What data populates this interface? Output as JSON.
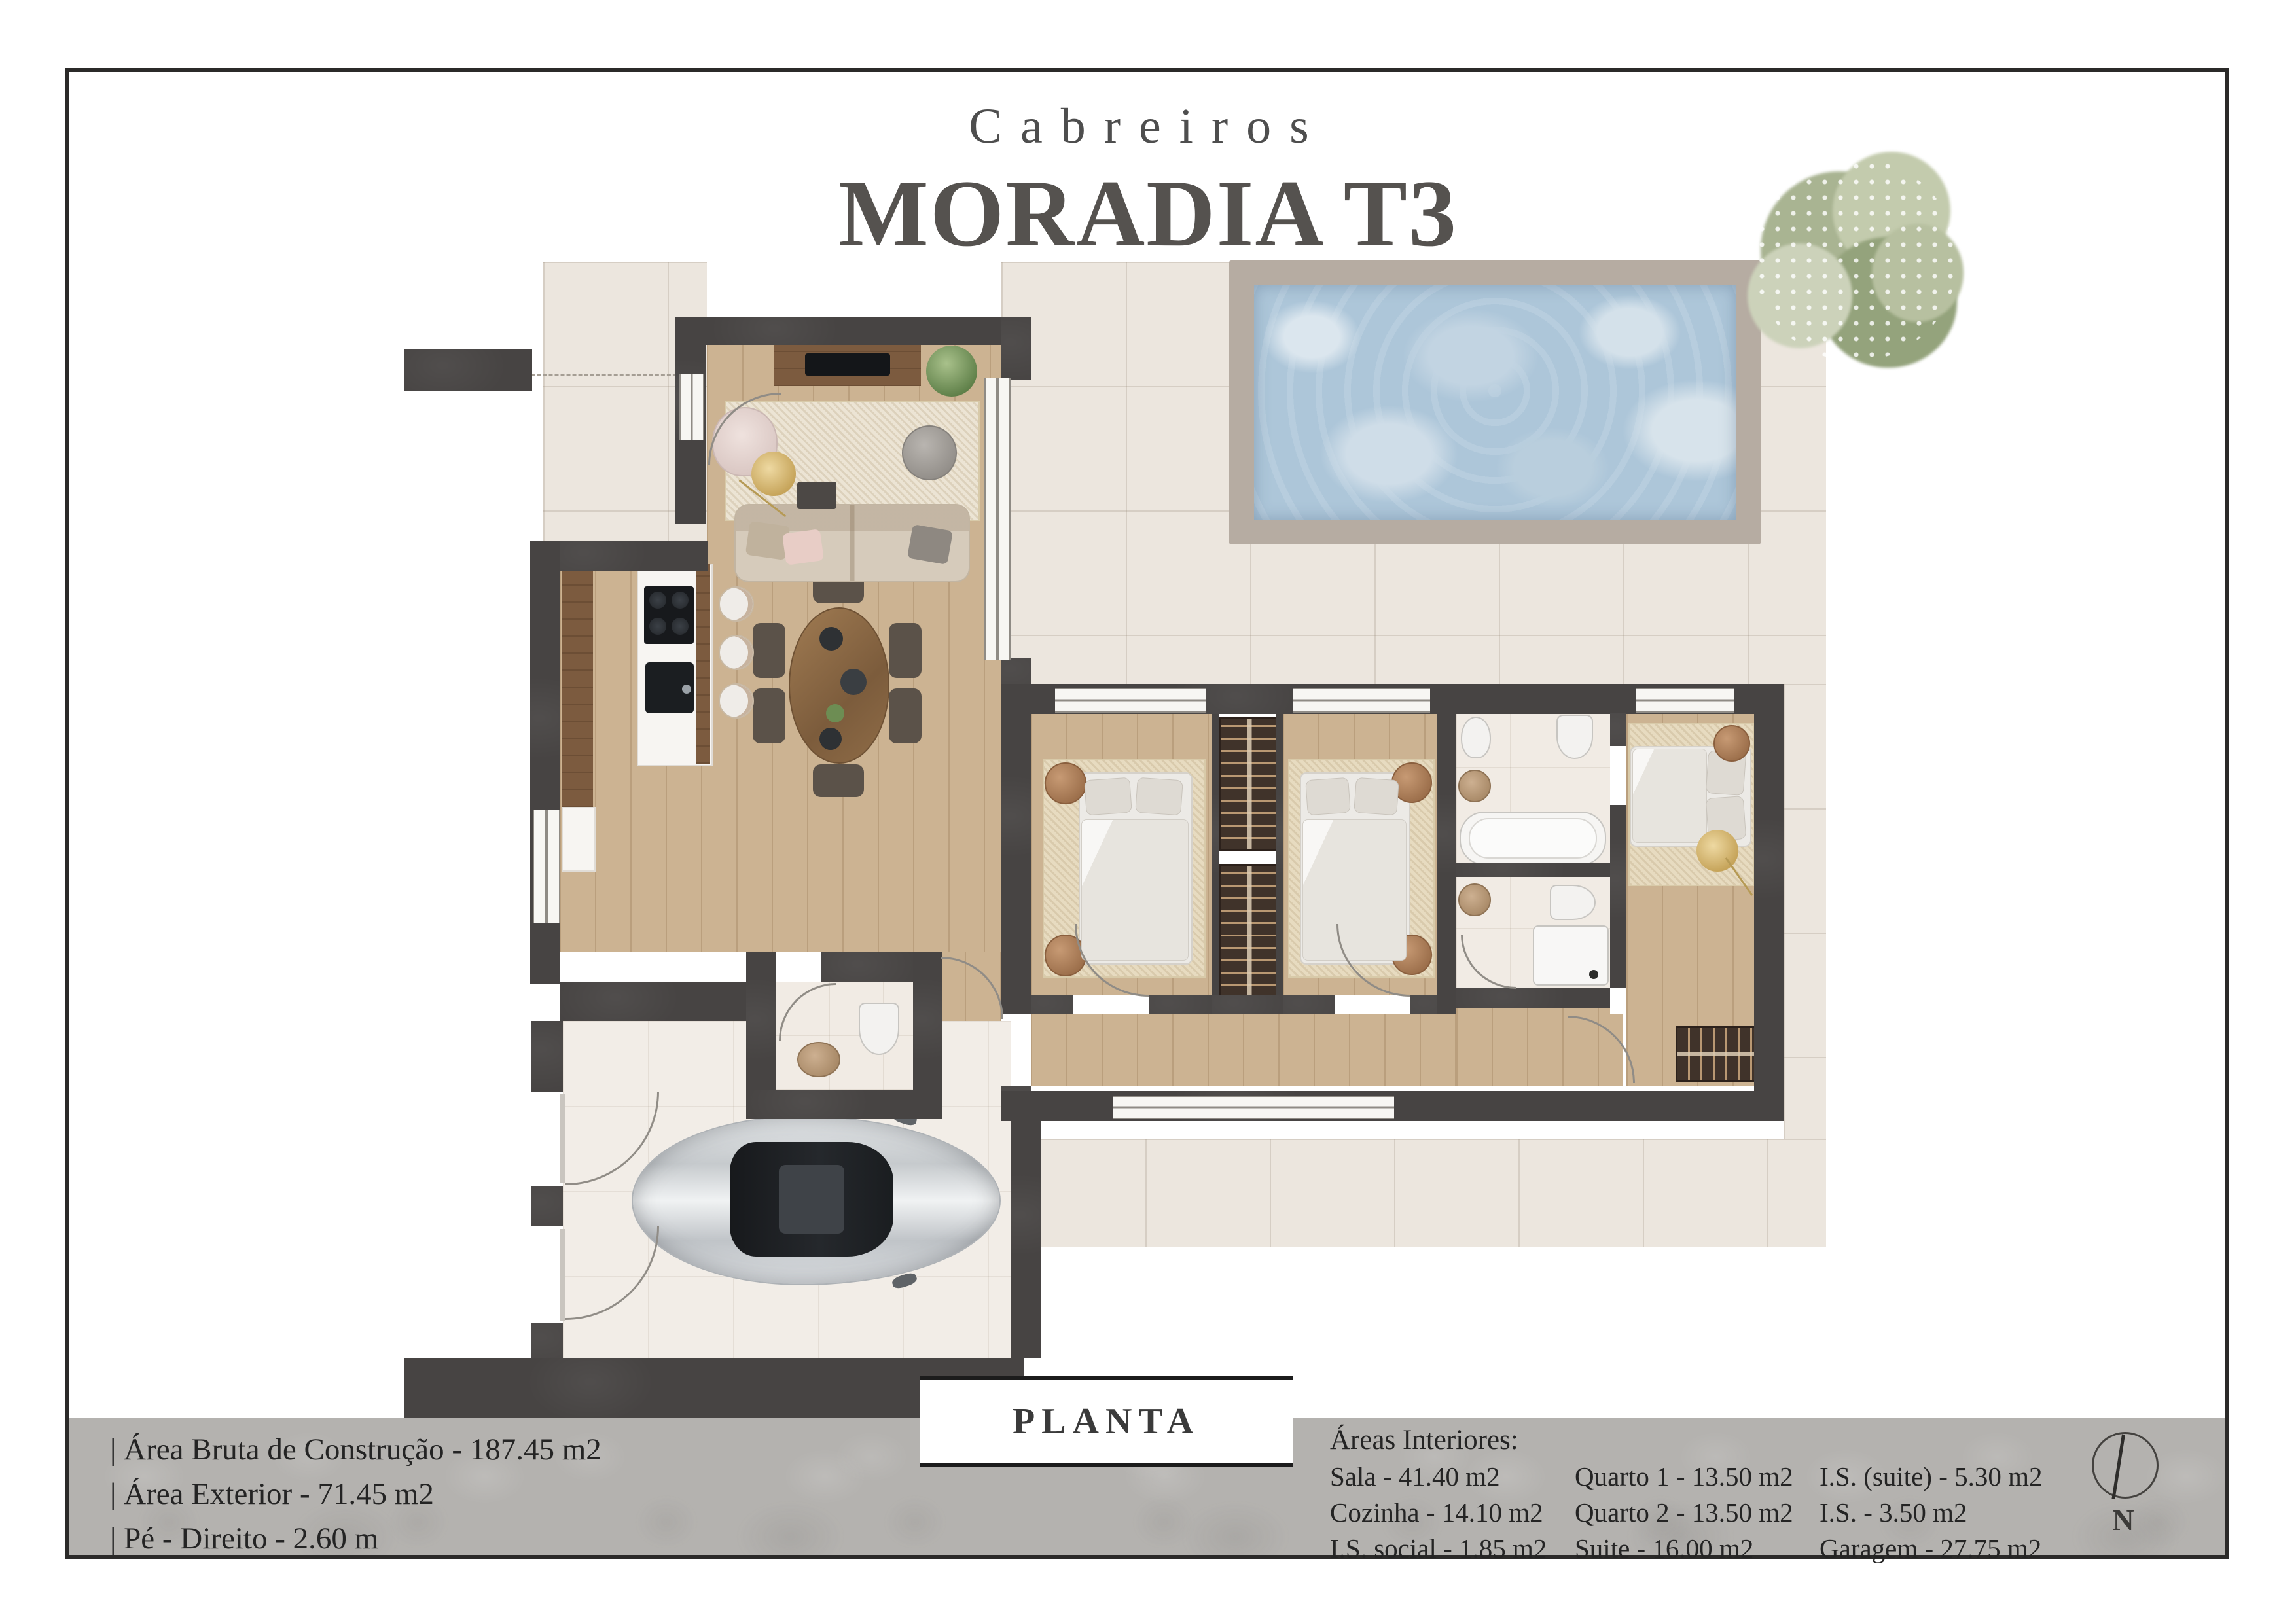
{
  "header": {
    "brand": "Cabreiros",
    "title": "MORADIA T3"
  },
  "plan": {
    "label": "PLANTA",
    "compass": "N"
  },
  "summary": {
    "lines": [
      "| Área Bruta de Construção - 187.45 m2",
      "| Área Exterior - 71.45 m2",
      "| Pé - Direito - 2.60 m"
    ]
  },
  "areas": {
    "heading": "Áreas Interiores:",
    "col1": [
      "Sala - 41.40 m2",
      "Cozinha - 14.10 m2",
      "I.S. social - 1.85 m2"
    ],
    "col2": [
      "Quarto 1 - 13.50 m2",
      "Quarto 2 - 13.50 m2",
      "Suite - 16.00 m2"
    ],
    "col3": [
      "I.S. (suite) - 5.30 m2",
      "I.S. - 3.50 m2",
      "Garagem - 27.75 m2"
    ]
  },
  "colors": {
    "wall": "#474443",
    "wood_floor": "#ccb392",
    "patio_tile": "#ece6de",
    "pool_water": "#adc6d9",
    "pool_coping": "#b6aca2",
    "footer_band": "#b4b2af",
    "title_text": "#55524f"
  }
}
